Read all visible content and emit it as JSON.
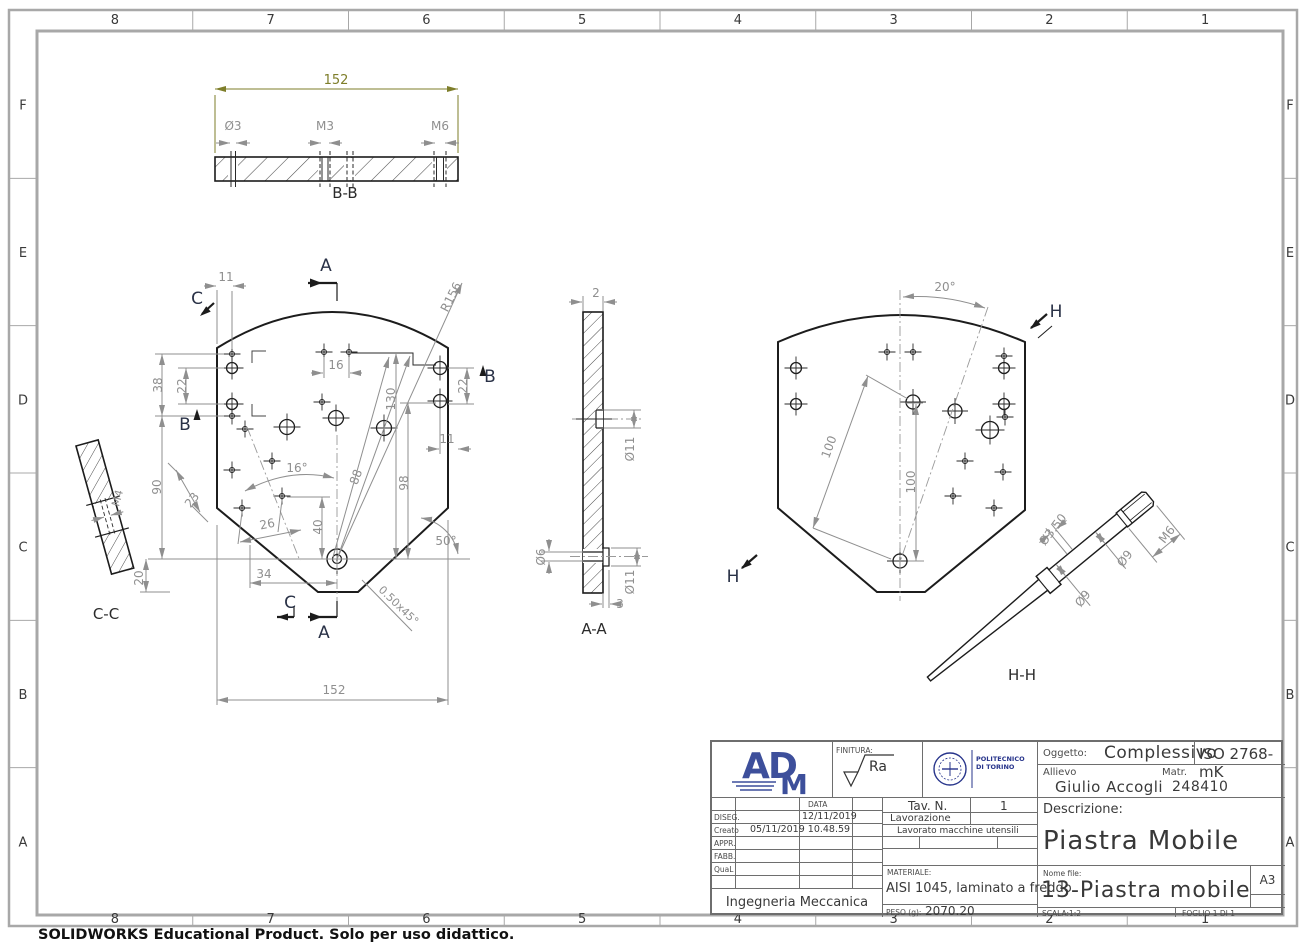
{
  "sheet": {
    "grid": {
      "columns": [
        "8",
        "7",
        "6",
        "5",
        "4",
        "3",
        "2",
        "1"
      ],
      "rows": [
        "F",
        "E",
        "D",
        "C",
        "B",
        "A"
      ]
    },
    "footer_note": "SOLIDWORKS Educational Product. Solo per uso didattico."
  },
  "colors": {
    "dim_gray": "#8f8f8f",
    "dim_accent_olive": "#7e7e2a",
    "line_black": "#1c1c1c",
    "border_gray": "#a8a8a8",
    "marker_navy": "#2a3247",
    "logo_blue": "#3d4f9b",
    "polito_blue": "#27348b"
  },
  "views": {
    "section_bb": {
      "label": "B-B",
      "dims": {
        "width": "152",
        "hole1": "Ø3",
        "hole2": "M3",
        "hole3": "M6"
      }
    },
    "front": {
      "markers": {
        "a": "A",
        "b": "B",
        "c": "C"
      },
      "dims": {
        "d11_top": "11",
        "d38": "38",
        "d22_left": "22",
        "d16": "16",
        "d130": "130",
        "d22_right": "22",
        "d11_right": "11",
        "r156": "R156",
        "d90": "90",
        "d23": "23",
        "a16": "16°",
        "d88": "88",
        "d98": "98",
        "d26": "26",
        "d40": "40",
        "d34": "34",
        "d20": "20",
        "d152": "152",
        "a50": "50°",
        "chamfer": "0.50x45°"
      }
    },
    "section_cc": {
      "label": "C-C",
      "dims": {
        "m4": "M4"
      }
    },
    "section_aa": {
      "label": "A-A",
      "dims": {
        "t": "2",
        "d11_mid": "Ø11",
        "d6": "Ø6",
        "d11_bot": "Ø11",
        "depth": "3"
      }
    },
    "back": {
      "marker": "H",
      "dims": {
        "a20": "20°",
        "d100_slant": "100",
        "d100_vert": "100"
      }
    },
    "section_hh": {
      "label": "H-H",
      "dims": {
        "d350": "Ø3.50",
        "d9_upper": "Ø9",
        "d9_lower": "Ø9",
        "m6": "M6"
      }
    }
  },
  "title_block": {
    "logo_letters": {
      "a": "A",
      "d": "D",
      "m": "M"
    },
    "finitura": {
      "label": "FINITURA:",
      "value": "Ra"
    },
    "politecnico": {
      "line1": "POLITECNICO",
      "line2": "DI TORINO"
    },
    "oggetto": {
      "label": "Oggetto:",
      "value": "Complessivo"
    },
    "tolerance": "ISO 2768-mK",
    "allievo": {
      "label": "Allievo",
      "value": "Giulio Accogli"
    },
    "matricola": {
      "label": "Matr.",
      "value": "248410"
    },
    "data_header": "DATA",
    "approval_rows": [
      {
        "label": "DISEG.",
        "value": "12/11/2019"
      },
      {
        "label": "Creato",
        "value": "05/11/2019 10.48.59"
      },
      {
        "label": "APPR.",
        "value": ""
      },
      {
        "label": "FABB.",
        "value": ""
      },
      {
        "label": "QuaL",
        "value": ""
      }
    ],
    "department": "Ingegneria Meccanica",
    "tav": {
      "label": "Tav. N.",
      "value": "1"
    },
    "lavorazione": {
      "label": "Lavorazione",
      "value": "Lavorato macchine utensili"
    },
    "materiale": {
      "label": "MATERIALE:",
      "value": "AISI 1045, laminato a freddo"
    },
    "peso": {
      "label": "PESO (g):",
      "value": "2070.20"
    },
    "descrizione": {
      "label": "Descrizione:",
      "value": "Piastra Mobile"
    },
    "nome_file": {
      "label": "Nome file:",
      "value": "13-Piastra mobile"
    },
    "formato": "A3",
    "scala": "SCALA:1:2",
    "foglio": "FOGLIO 1 DI 1"
  }
}
